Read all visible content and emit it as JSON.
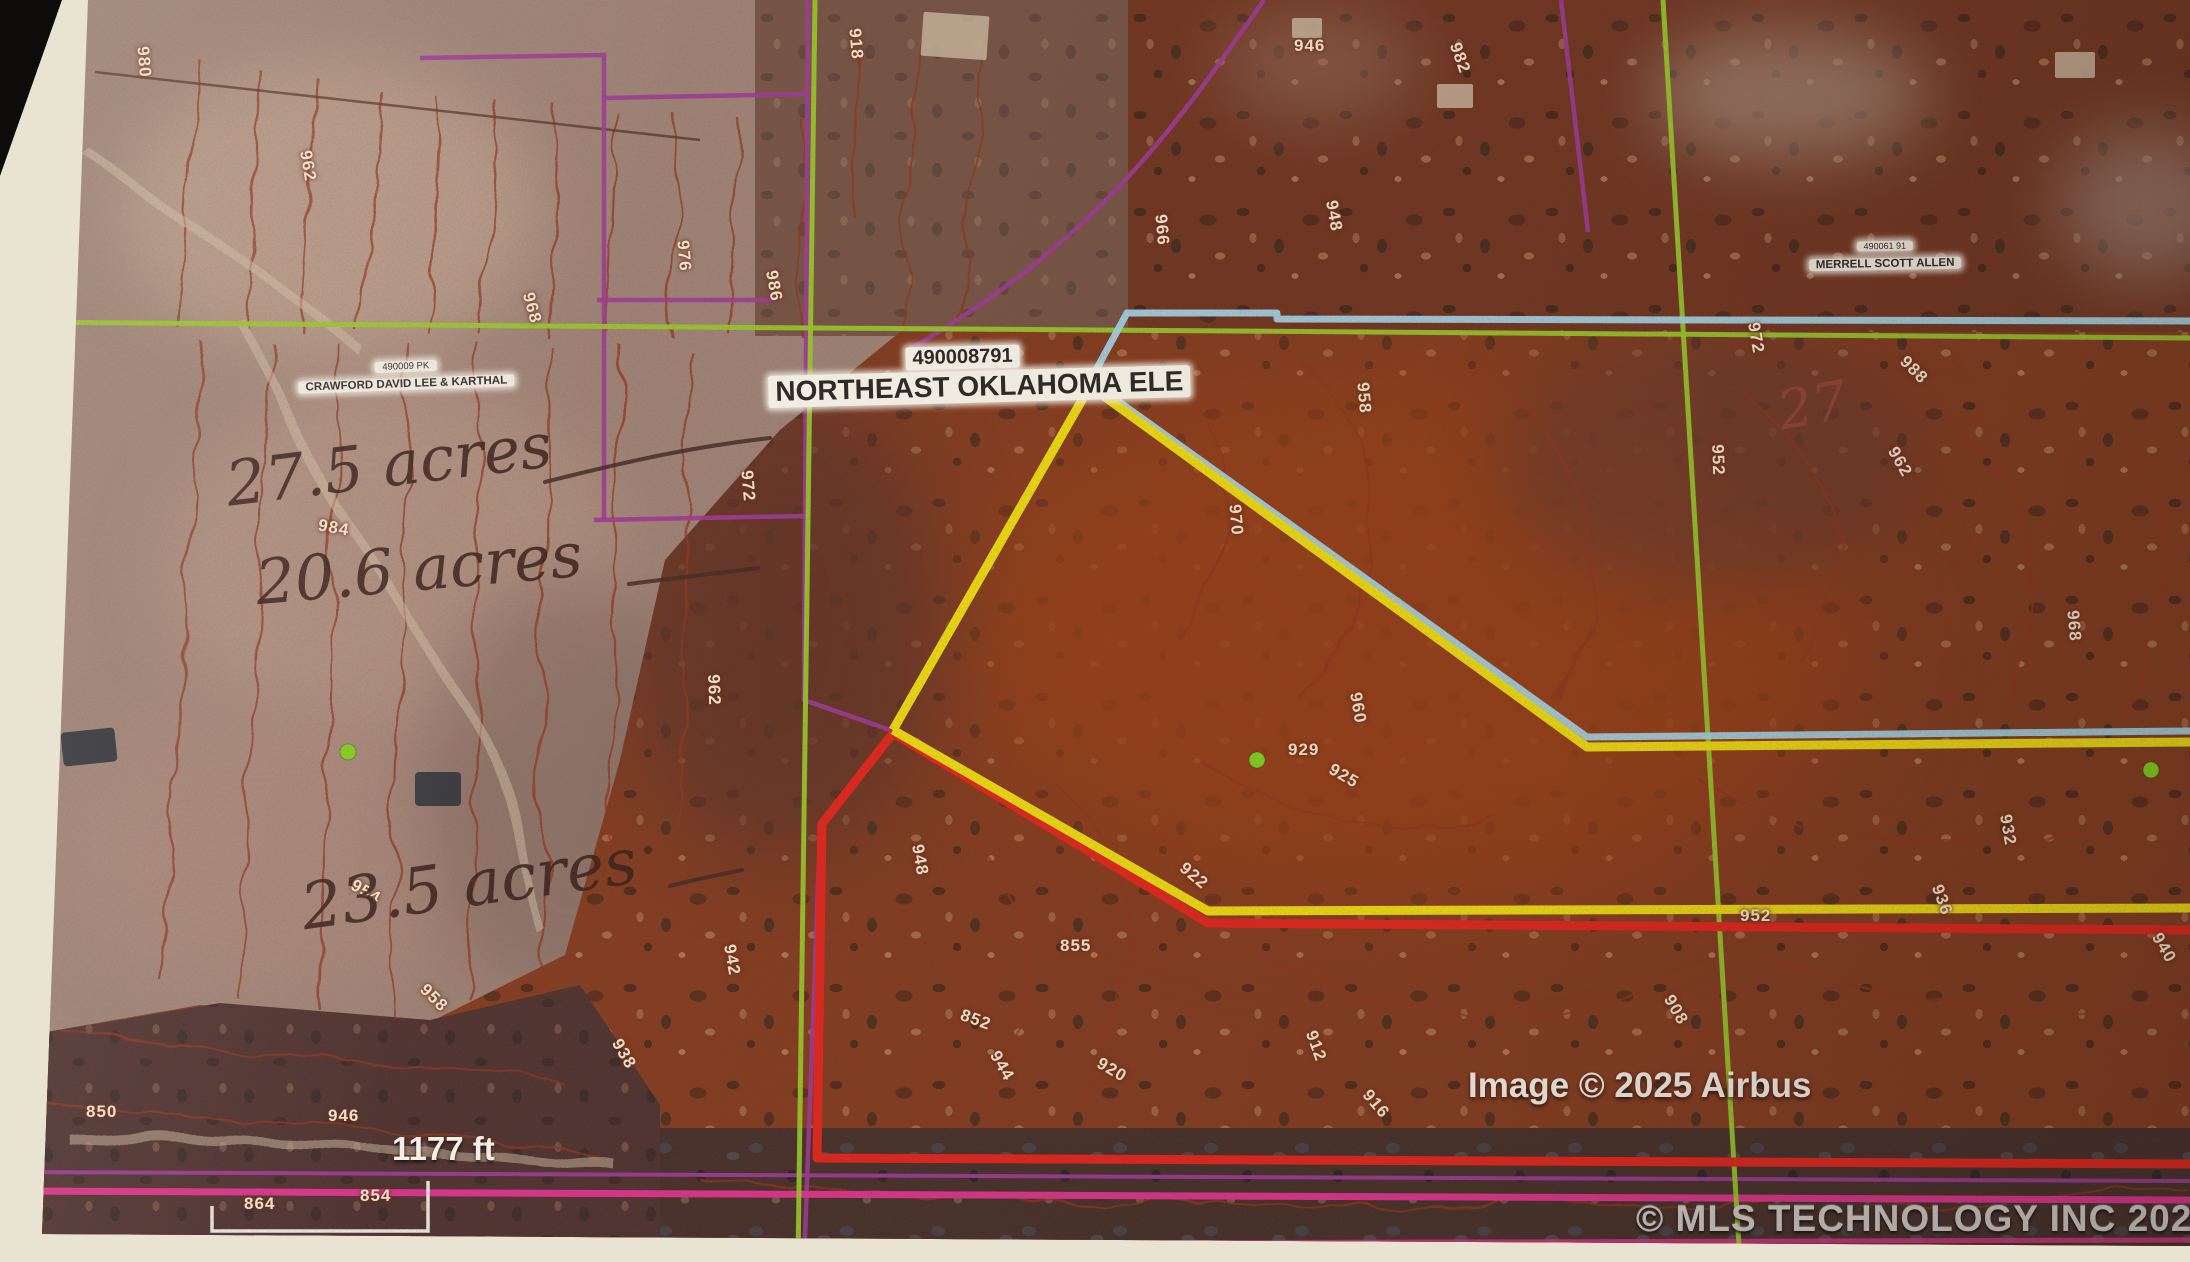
{
  "colors": {
    "c-green": "#9ccd2b",
    "c-purple": "#a23a9c",
    "c-pink": "#e23390",
    "c-cyan": "#a9dbee",
    "c-yellow": "#f6e411",
    "c-red": "#e8251c",
    "c-contour": "#93351f"
  },
  "labels": {
    "parcel": {
      "id": "490008791",
      "name": "NORTHEAST OKLAHOMA ELE"
    },
    "crawford": {
      "id": "490009 PK",
      "name": "CRAWFORD DAVID LEE & KARTHAL"
    },
    "merrell": {
      "id": "490061 91",
      "name": "MERRELL SCOTT ALLEN"
    }
  },
  "annotations": {
    "area1": "27.5 acres",
    "area2": "20.6 acres",
    "area3": "23.5 acres",
    "corner_note": "27"
  },
  "scale_label": "1177 ft",
  "credits": {
    "imagery": "Image © 2025 Airbus",
    "provider": "© MLS TECHNOLOGY INC 2025"
  },
  "contours": [
    {
      "v": "980",
      "x": 128,
      "y": 52,
      "r": 85
    },
    {
      "v": "962",
      "x": 292,
      "y": 156,
      "r": 80
    },
    {
      "v": "968",
      "x": 516,
      "y": 298,
      "r": 75
    },
    {
      "v": "976",
      "x": 668,
      "y": 246,
      "r": 85
    },
    {
      "v": "986",
      "x": 758,
      "y": 276,
      "r": 80
    },
    {
      "v": "918",
      "x": 840,
      "y": 34,
      "r": 85
    },
    {
      "v": "946",
      "x": 1294,
      "y": 36,
      "r": 0
    },
    {
      "v": "982",
      "x": 1444,
      "y": 48,
      "r": 70
    },
    {
      "v": "948",
      "x": 1318,
      "y": 206,
      "r": 80
    },
    {
      "v": "966",
      "x": 1146,
      "y": 220,
      "r": 85
    },
    {
      "v": "984",
      "x": 318,
      "y": 518,
      "r": 10
    },
    {
      "v": "972",
      "x": 732,
      "y": 476,
      "r": 85
    },
    {
      "v": "962",
      "x": 698,
      "y": 680,
      "r": 88
    },
    {
      "v": "958",
      "x": 1348,
      "y": 388,
      "r": 85
    },
    {
      "v": "970",
      "x": 1220,
      "y": 510,
      "r": 85
    },
    {
      "v": "952",
      "x": 1702,
      "y": 450,
      "r": 88
    },
    {
      "v": "972",
      "x": 1740,
      "y": 328,
      "r": 80
    },
    {
      "v": "988",
      "x": 1898,
      "y": 360,
      "r": 45
    },
    {
      "v": "962",
      "x": 1884,
      "y": 452,
      "r": 60
    },
    {
      "v": "968",
      "x": 2058,
      "y": 616,
      "r": 85
    },
    {
      "v": "960",
      "x": 1342,
      "y": 698,
      "r": 80
    },
    {
      "v": "929",
      "x": 1288,
      "y": 740,
      "r": 0
    },
    {
      "v": "925",
      "x": 1328,
      "y": 766,
      "r": 30
    },
    {
      "v": "948",
      "x": 904,
      "y": 850,
      "r": 80
    },
    {
      "v": "855",
      "x": 1060,
      "y": 936,
      "r": 0
    },
    {
      "v": "852",
      "x": 960,
      "y": 1010,
      "r": 20
    },
    {
      "v": "922",
      "x": 1178,
      "y": 866,
      "r": 40
    },
    {
      "v": "942",
      "x": 716,
      "y": 950,
      "r": 80
    },
    {
      "v": "938",
      "x": 608,
      "y": 1044,
      "r": 60
    },
    {
      "v": "954",
      "x": 350,
      "y": 882,
      "r": 30
    },
    {
      "v": "958",
      "x": 418,
      "y": 988,
      "r": 45
    },
    {
      "v": "946",
      "x": 328,
      "y": 1106,
      "r": 0
    },
    {
      "v": "850",
      "x": 86,
      "y": 1102,
      "r": 0
    },
    {
      "v": "854",
      "x": 360,
      "y": 1186,
      "r": 0
    },
    {
      "v": "864",
      "x": 244,
      "y": 1194,
      "r": 0
    },
    {
      "v": "944",
      "x": 986,
      "y": 1056,
      "r": 60
    },
    {
      "v": "920",
      "x": 1096,
      "y": 1060,
      "r": 30
    },
    {
      "v": "912",
      "x": 1300,
      "y": 1036,
      "r": 70
    },
    {
      "v": "916",
      "x": 1360,
      "y": 1094,
      "r": 50
    },
    {
      "v": "908",
      "x": 1660,
      "y": 1000,
      "r": 60
    },
    {
      "v": "952",
      "x": 1740,
      "y": 906,
      "r": 0
    },
    {
      "v": "932",
      "x": 1992,
      "y": 820,
      "r": 80
    },
    {
      "v": "936",
      "x": 1926,
      "y": 890,
      "r": 70
    },
    {
      "v": "940",
      "x": 2148,
      "y": 938,
      "r": 60
    }
  ]
}
